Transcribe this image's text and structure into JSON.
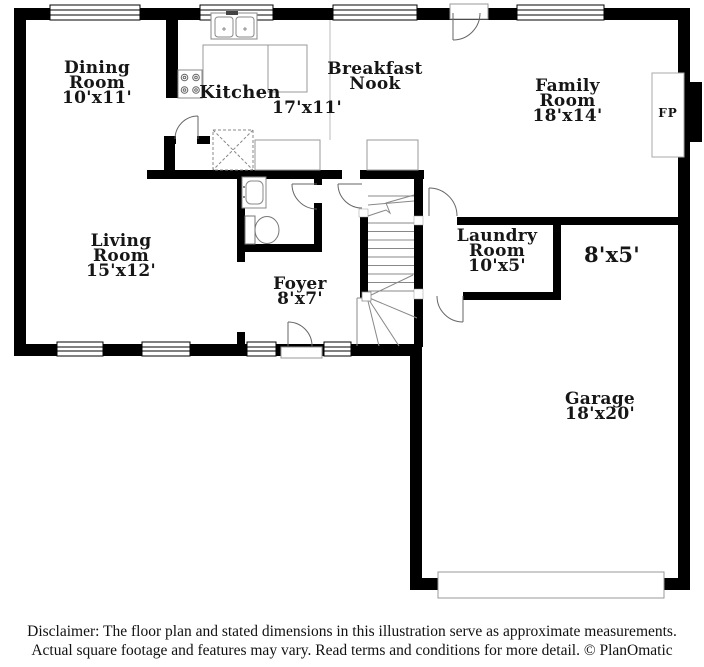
{
  "plan": {
    "rooms": {
      "dining": {
        "name": "Dining Room",
        "dims": "10'x11'"
      },
      "kitchen": {
        "name": "Kitchen",
        "dims": "17'x11'"
      },
      "breakfast": {
        "name": "Breakfast Nook"
      },
      "family": {
        "name": "Family Room",
        "dims": "18'x14'"
      },
      "living": {
        "name": "Living Room",
        "dims": "15'x12'"
      },
      "foyer": {
        "name": "Foyer",
        "dims": "8'x7'"
      },
      "laundry": {
        "name": "Laundry Room",
        "dims": "10'x5'"
      },
      "storage": {
        "dims": "8'x5'"
      },
      "garage": {
        "name": "Garage",
        "dims": "18'x20'"
      },
      "fireplace": {
        "abbr": "FP"
      }
    },
    "icons": [
      "kitchen-sink-icon",
      "stove-icon",
      "pantry-x-icon",
      "bathroom-sink-icon",
      "toilet-icon",
      "staircase-icon",
      "door-swing-icon",
      "window-icon",
      "fireplace-icon",
      "garage-door-icon"
    ],
    "colors": {
      "wall": "#000000",
      "fixture_line": "#8a8a8a",
      "background": "#ffffff",
      "text": "#161616"
    }
  },
  "footer": {
    "line1": "Disclaimer: The floor plan and stated dimensions in this illustration serve as approximate measurements.",
    "line2": "Actual square footage and features may vary. Read terms and conditions for more detail. © PlanOmatic"
  }
}
